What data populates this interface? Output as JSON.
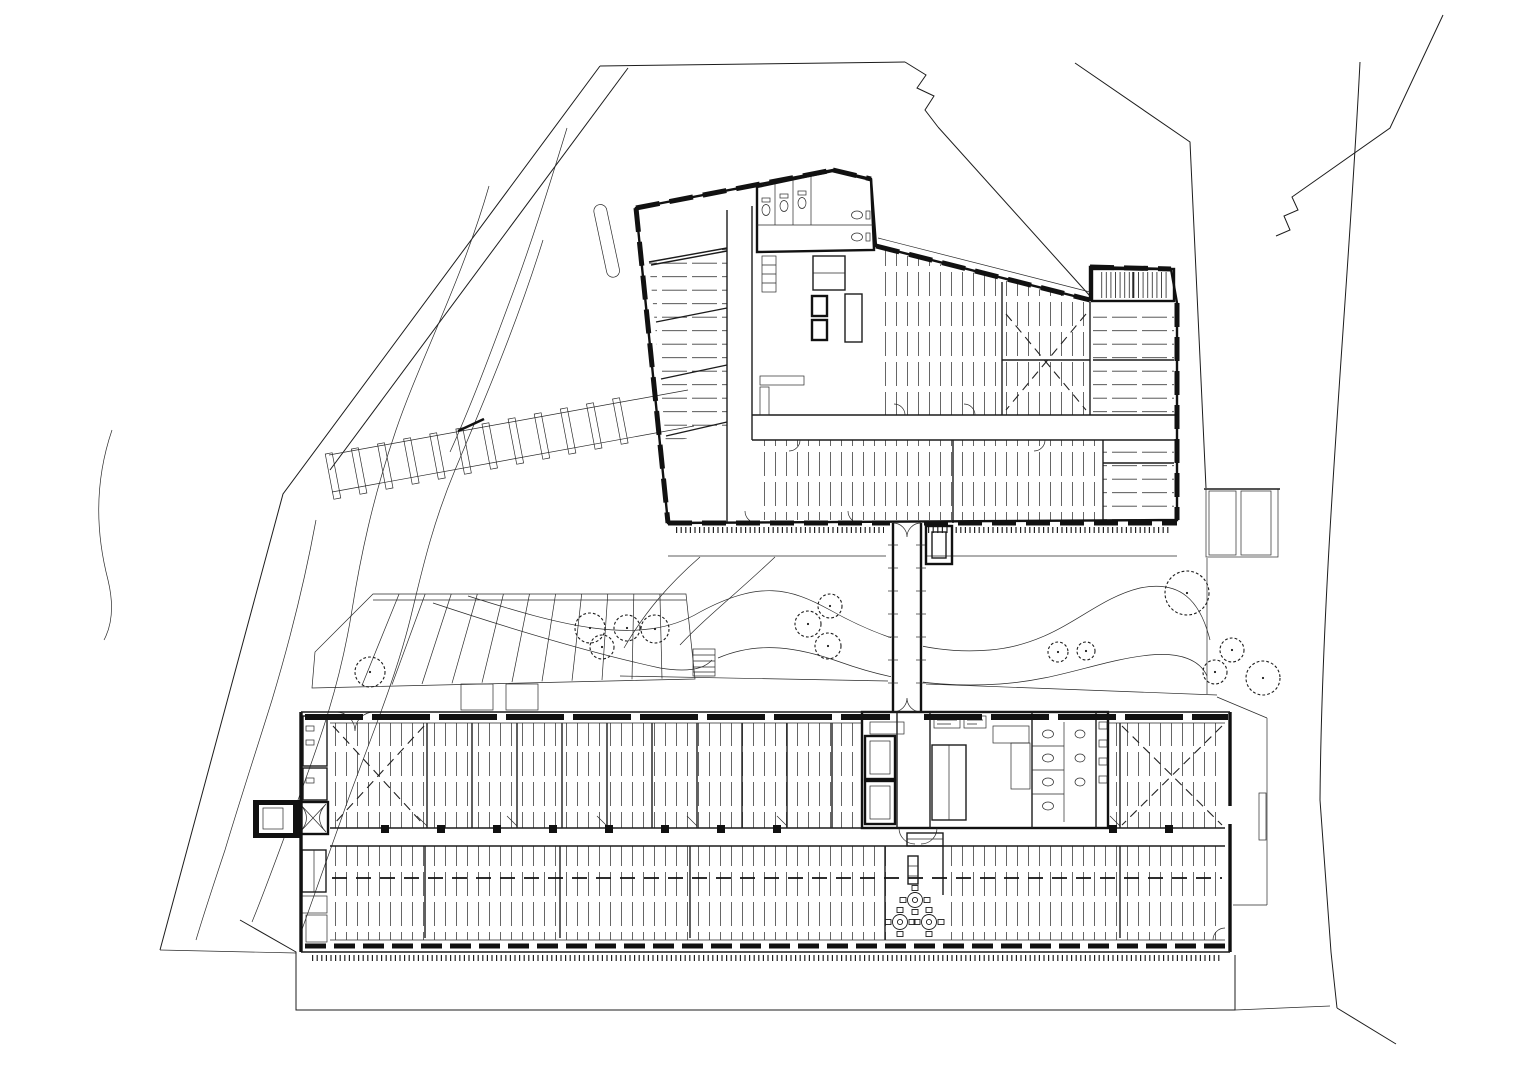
{
  "document": {
    "type": "architectural site and floor plan",
    "paper_color": "#ffffff",
    "ink_color": "#1c1c1c",
    "visible_text_labels": []
  },
  "plan": {
    "north_building": {
      "name": "angled north block",
      "features": [
        "perimeter window modules",
        "central WC and stair core",
        "hatched office rooms",
        "L corridor",
        "roof stair block"
      ]
    },
    "south_building": {
      "name": "long south block",
      "features": [
        "double row of hatched rooms",
        "central corridor with columns",
        "service core with elevators, stair, WC",
        "cafeteria tables",
        "west stair annex"
      ]
    },
    "bridge": {
      "name": "link corridor",
      "ticks": {
        "y0": 545,
        "y1": 700,
        "step": 23,
        "xl1": 888,
        "xl2": 898,
        "xr1": 916,
        "xr2": 926
      }
    },
    "trees": [
      {
        "x": 370,
        "y": 672,
        "r": 15
      },
      {
        "x": 590,
        "y": 628,
        "r": 15
      },
      {
        "x": 602,
        "y": 647,
        "r": 12
      },
      {
        "x": 627,
        "y": 628,
        "r": 13
      },
      {
        "x": 655,
        "y": 629,
        "r": 14
      },
      {
        "x": 808,
        "y": 624,
        "r": 13
      },
      {
        "x": 830,
        "y": 606,
        "r": 12
      },
      {
        "x": 828,
        "y": 646,
        "r": 13
      },
      {
        "x": 1058,
        "y": 652,
        "r": 10
      },
      {
        "x": 1086,
        "y": 651,
        "r": 9
      },
      {
        "x": 1187,
        "y": 593,
        "r": 22
      },
      {
        "x": 1232,
        "y": 650,
        "r": 12
      },
      {
        "x": 1215,
        "y": 672,
        "r": 12
      },
      {
        "x": 1263,
        "y": 678,
        "r": 17
      }
    ],
    "parking": {
      "stall_count": 12,
      "x0": 333,
      "y0": 476,
      "ux": 0.982,
      "uy": -0.188,
      "spacing": 26.6,
      "stall_w": 7,
      "stall_l": 46,
      "angle_deg": -10.8
    },
    "columns": {
      "y": 829,
      "size": 8,
      "xs": [
        385,
        441,
        497,
        553,
        609,
        665,
        721,
        777,
        1113,
        1169
      ]
    },
    "cafeteria_tables": [
      {
        "x": 915,
        "y": 900
      },
      {
        "x": 900,
        "y": 922
      },
      {
        "x": 929,
        "y": 922
      }
    ],
    "garden_band": {
      "top": [
        [
          373,
          594
        ],
        [
          686,
          594
        ]
      ],
      "bottom": [
        [
          332,
          686
        ],
        [
          692,
          678
        ]
      ],
      "panels": 11
    }
  }
}
